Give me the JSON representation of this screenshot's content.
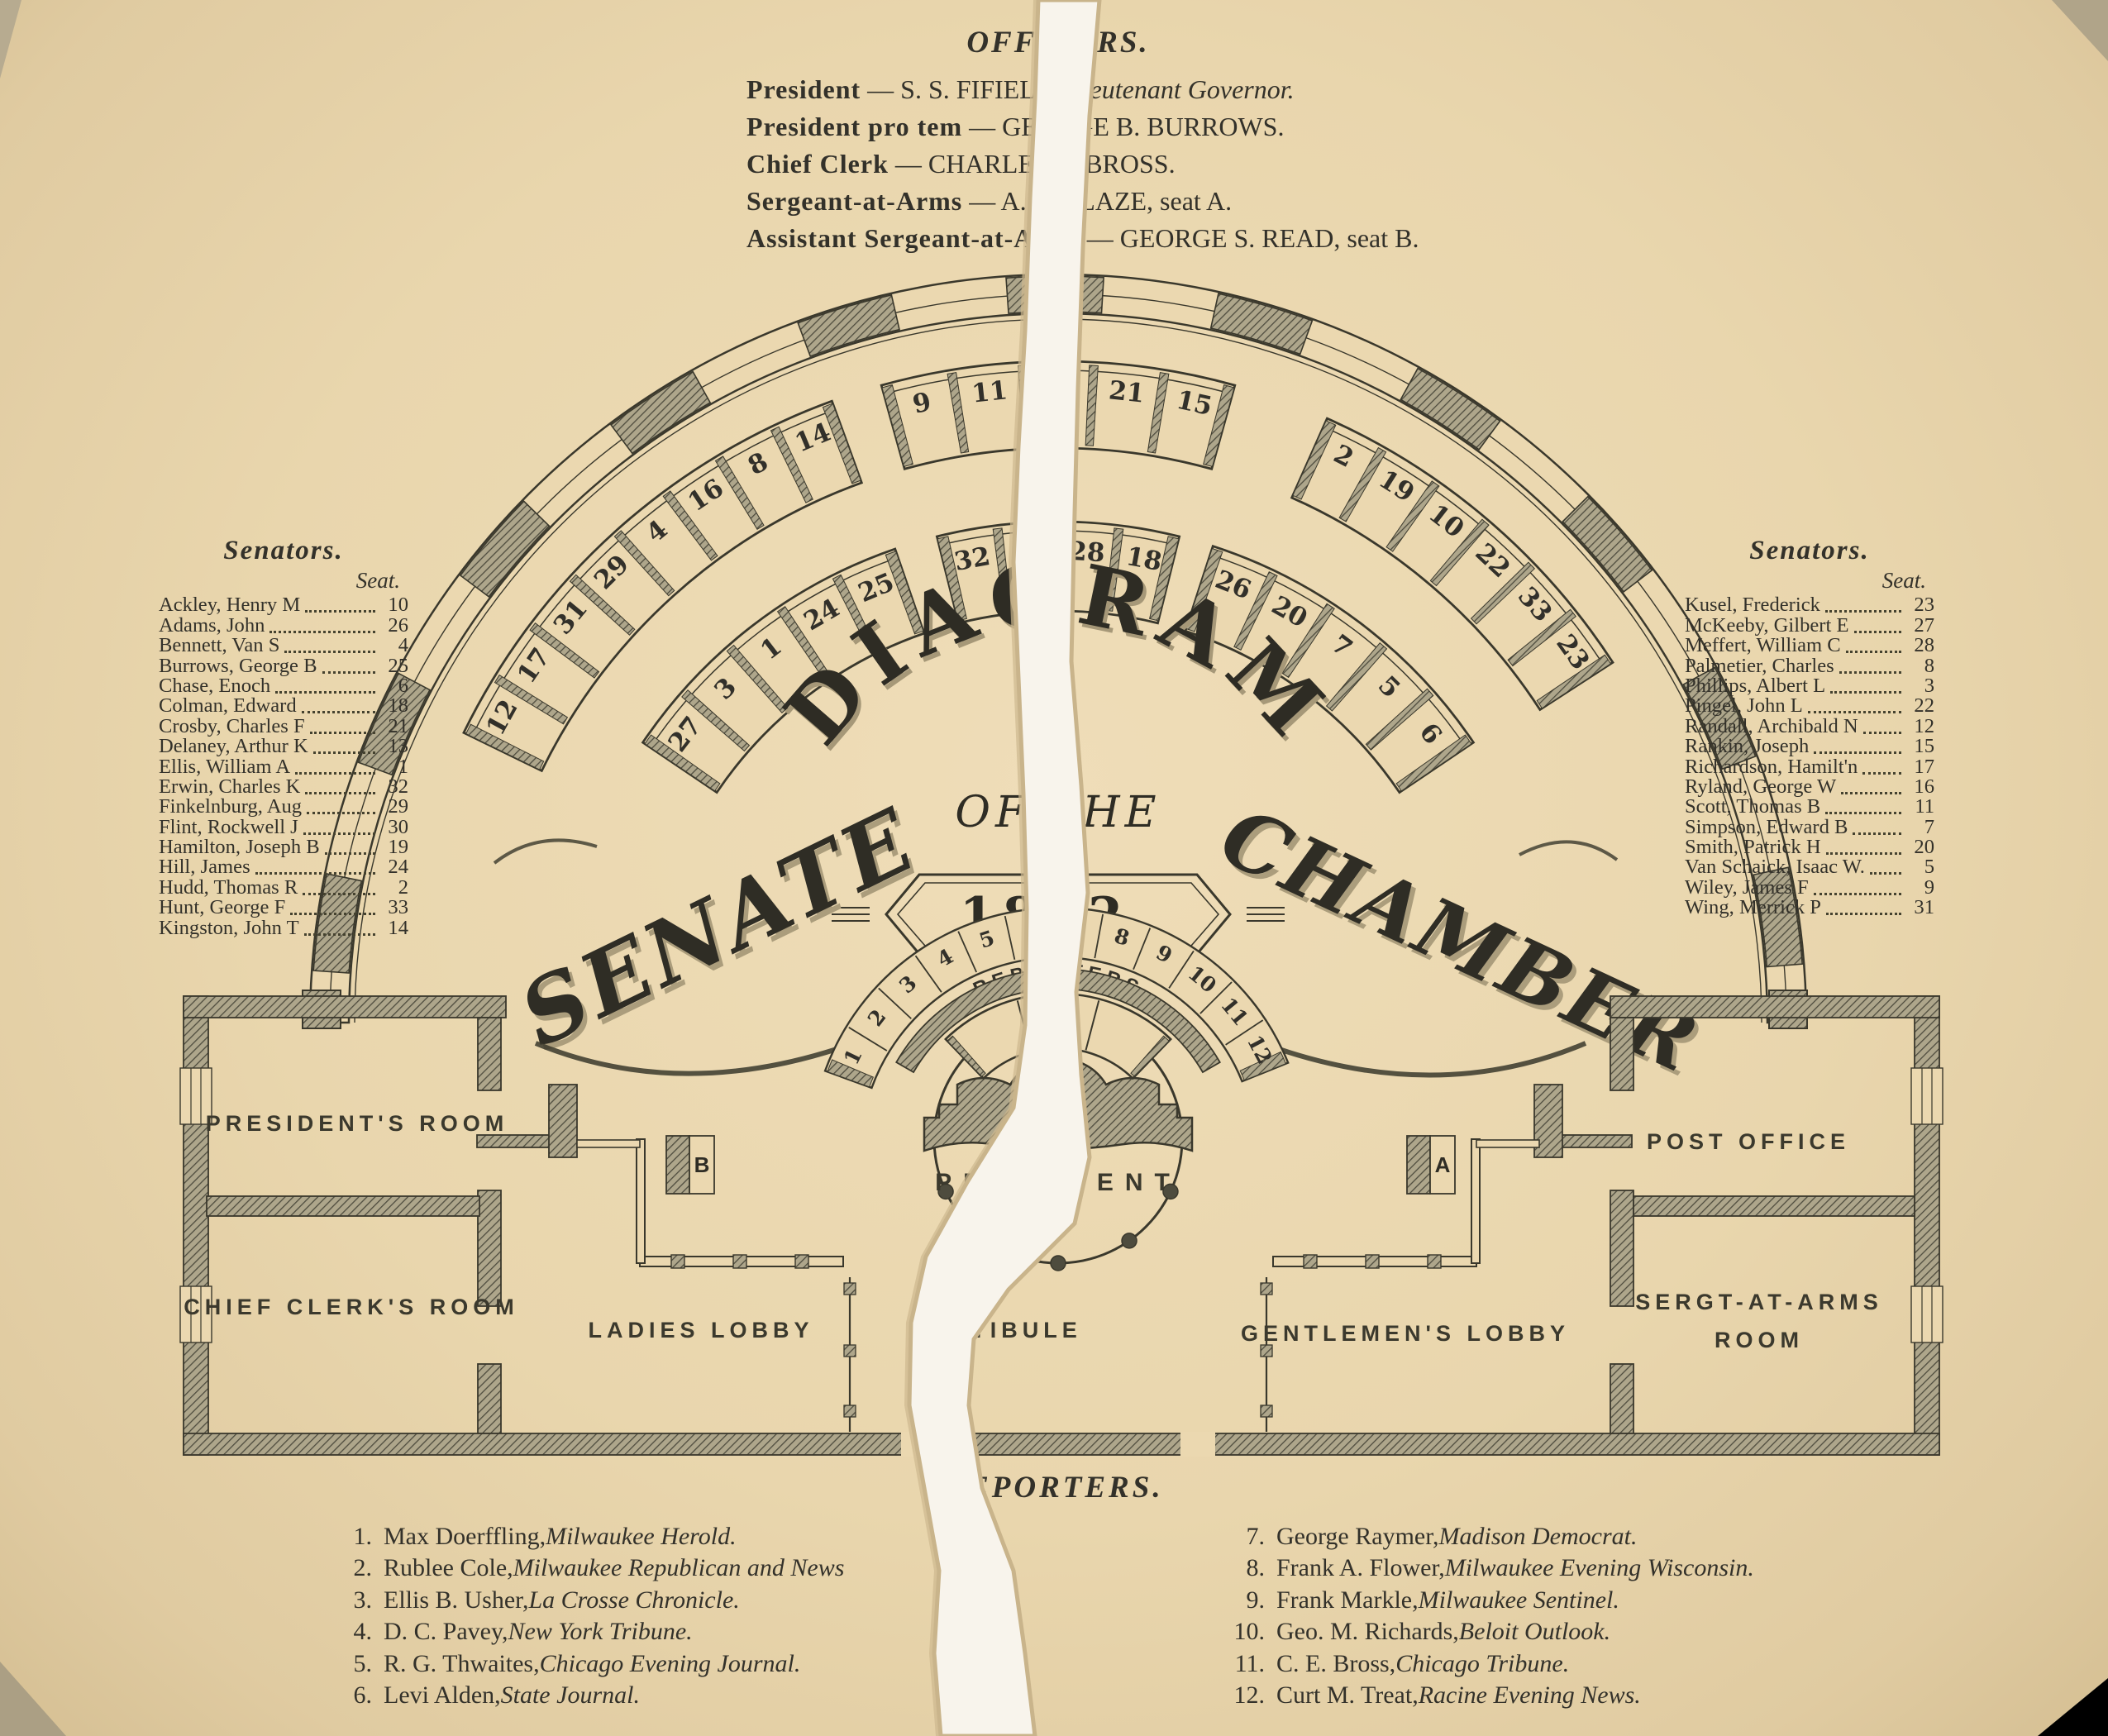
{
  "officers": {
    "heading": "OFFICERS.",
    "entries": [
      {
        "label": "President",
        "name": " — S. S. FIFIELD, ",
        "tail": "Lieutenant Governor."
      },
      {
        "label": "President pro tem",
        "name": " — GEORGE B. BURROWS.",
        "tail": ""
      },
      {
        "label": "Chief Clerk",
        "name": " — CHARLES E. BROSS.",
        "tail": ""
      },
      {
        "label": "Sergeant-at-Arms",
        "name": " — A. T. GLAZE, seat A.",
        "tail": ""
      },
      {
        "label": "Assistant Sergeant-at-Arms",
        "name": " — GEORGE S. READ, seat B.",
        "tail": ""
      }
    ]
  },
  "senators_left": {
    "heading": "Senators.",
    "seat_label": "Seat.",
    "rows": [
      {
        "name": "Ackley, Henry M",
        "seat": "10"
      },
      {
        "name": "Adams, John",
        "seat": "26"
      },
      {
        "name": "Bennett, Van S",
        "seat": "4"
      },
      {
        "name": "Burrows, George B",
        "seat": "25"
      },
      {
        "name": "Chase, Enoch",
        "seat": "6"
      },
      {
        "name": "Colman, Edward",
        "seat": "18"
      },
      {
        "name": "Crosby, Charles F",
        "seat": "21"
      },
      {
        "name": "Delaney, Arthur K",
        "seat": "13"
      },
      {
        "name": "Ellis, William A",
        "seat": "1"
      },
      {
        "name": "Erwin, Charles K",
        "seat": "32"
      },
      {
        "name": "Finkelnburg, Aug",
        "seat": "29"
      },
      {
        "name": "Flint, Rockwell J",
        "seat": "30"
      },
      {
        "name": "Hamilton, Joseph B",
        "seat": "19"
      },
      {
        "name": "Hill, James",
        "seat": "24"
      },
      {
        "name": "Hudd, Thomas R",
        "seat": "2"
      },
      {
        "name": "Hunt, George F",
        "seat": "33"
      },
      {
        "name": "Kingston, John T",
        "seat": "14"
      }
    ]
  },
  "senators_right": {
    "heading": "Senators.",
    "seat_label": "Seat.",
    "rows": [
      {
        "name": "Kusel, Frederick",
        "seat": "23"
      },
      {
        "name": "McKeeby, Gilbert E",
        "seat": "27"
      },
      {
        "name": "Meffert, William C",
        "seat": "28"
      },
      {
        "name": "Palmetier, Charles",
        "seat": "8"
      },
      {
        "name": "Phillips, Albert L",
        "seat": "3"
      },
      {
        "name": "Pingel, John L",
        "seat": "22"
      },
      {
        "name": "Randall, Archibald N",
        "seat": "12"
      },
      {
        "name": "Rankin, Joseph",
        "seat": "15"
      },
      {
        "name": "Richardson, Hamilt'n",
        "seat": "17"
      },
      {
        "name": "Ryland, George W",
        "seat": "16"
      },
      {
        "name": "Scott, Thomas B",
        "seat": "11"
      },
      {
        "name": "Simpson, Edward B",
        "seat": "7"
      },
      {
        "name": "Smith, Patrick H",
        "seat": "20"
      },
      {
        "name": "Van Schaick, Isaac W.",
        "seat": "5"
      },
      {
        "name": "Wiley, James F",
        "seat": "9"
      },
      {
        "name": "Wing, Merrick P",
        "seat": "31"
      }
    ]
  },
  "reporters": {
    "heading": "REPORTERS.",
    "left": [
      {
        "num": "1.",
        "name": "Max Doerffling, ",
        "paper": "Milwaukee Herold."
      },
      {
        "num": "2.",
        "name": "Rublee Cole, ",
        "paper": "Milwaukee Republican and News"
      },
      {
        "num": "3.",
        "name": "Ellis B. Usher, ",
        "paper": "La Crosse Chronicle."
      },
      {
        "num": "4.",
        "name": "D. C. Pavey, ",
        "paper": "New York Tribune."
      },
      {
        "num": "5.",
        "name": "R. G. Thwaites, ",
        "paper": "Chicago Evening Journal."
      },
      {
        "num": "6.",
        "name": "Levi Alden, ",
        "paper": "State Journal."
      }
    ],
    "right": [
      {
        "num": "7.",
        "name": "George Raymer, ",
        "paper": "Madison Democrat."
      },
      {
        "num": "8.",
        "name": "Frank A. Flower, ",
        "paper": "Milwaukee Evening Wisconsin."
      },
      {
        "num": "9.",
        "name": "Frank Markle, ",
        "paper": "Milwaukee Sentinel."
      },
      {
        "num": "10.",
        "name": "Geo. M. Richards, ",
        "paper": "Beloit Outlook."
      },
      {
        "num": "11.",
        "name": "C. E. Bross, ",
        "paper": "Chicago Tribune."
      },
      {
        "num": "12.",
        "name": "Curt M. Treat, ",
        "paper": "Racine Evening News."
      }
    ]
  },
  "diagram": {
    "title_arc": "DIAGRAM",
    "title_of_the": "OF THE",
    "title_year": "1882.",
    "title_left": "SENATE",
    "title_right": "CHAMBER",
    "labels": {
      "president": "PRESIDENT",
      "chief_clerk": "CHIEF CLERK",
      "reporters": "REPORTERS",
      "presidents_room": "PRESIDENT'S ROOM",
      "chief_clerks_room": "CHIEF CLERK'S ROOM",
      "ladies_lobby": "LADIES LOBBY",
      "vestibule": "VESTIBULE",
      "gentlemens_lobby": "GENTLEMEN'S LOBBY",
      "post_office": "POST OFFICE",
      "sergt_room_line1": "SERGT-AT-ARMS",
      "sergt_room_line2": "ROOM",
      "box_a": "A",
      "box_b": "B"
    },
    "rings": {
      "outer": {
        "r_in": 695,
        "r_out": 800,
        "num_r": 757,
        "segments": [
          {
            "seats": [
              "12",
              "17",
              "31",
              "29",
              "4",
              "16",
              "8",
              "14"
            ],
            "a1": 154,
            "a2": 110
          },
          {
            "seats": [
              "9",
              "11",
              "13",
              "21",
              "15"
            ],
            "a1": 105.5,
            "a2": 74.5
          },
          {
            "seats": [
              "2",
              "19",
              "10",
              "22",
              "33",
              "23"
            ],
            "a1": 66,
            "a2": 33
          }
        ]
      },
      "inner": {
        "r_in": 498,
        "r_out": 606,
        "num_r": 560,
        "segments": [
          {
            "seats": [
              "27",
              "3",
              "1",
              "24",
              "25"
            ],
            "a1": 146,
            "a2": 109
          },
          {
            "seats": [
              "32",
              "30",
              "28",
              "18"
            ],
            "a1": 104,
            "a2": 76
          },
          {
            "seats": [
              "26",
              "20",
              "7",
              "5",
              "6"
            ],
            "a1": 72,
            "a2": 34
          }
        ]
      },
      "reporters": {
        "r_in": 240,
        "r_out": 300,
        "num_r": 267,
        "segments": [
          {
            "seats": [
              "1",
              "2",
              "3",
              "4",
              "5",
              "6",
              "7",
              "8",
              "9",
              "10",
              "11",
              "12"
            ],
            "a1": 160,
            "a2": 22
          }
        ]
      }
    }
  },
  "colors": {
    "paper": "#e9d6ad",
    "ink": "#33312a",
    "wall_hatch_bg": "#aea68b",
    "wall_hatch_line": "#4e4c3e",
    "tear_white": "#f8f4ec",
    "tear_edge": "#c9b48b"
  }
}
